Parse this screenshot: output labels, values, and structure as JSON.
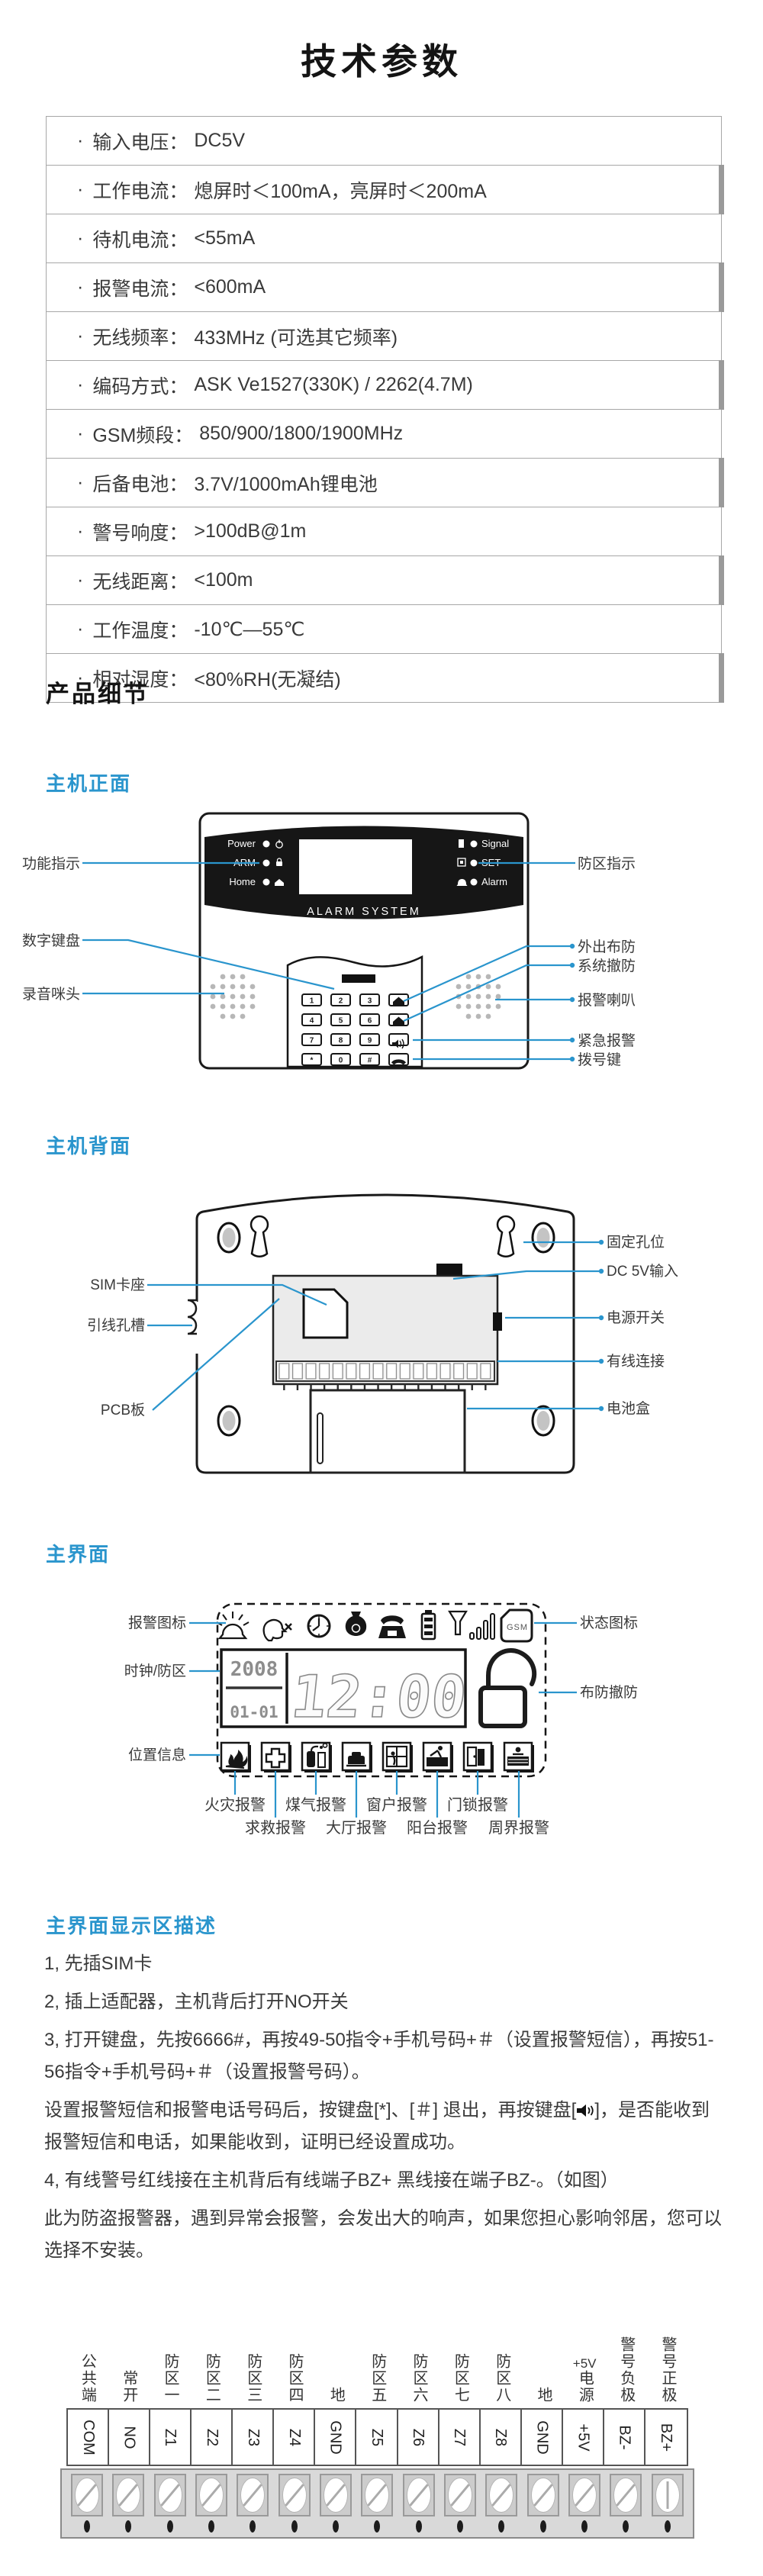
{
  "colors": {
    "accent": "#2a95cd",
    "text": "#3a3a3a",
    "table_border": "#a7a7a7",
    "row_tick": "#9a9a9a"
  },
  "title": "技术参数",
  "specs": {
    "bullet": "·",
    "rows": [
      {
        "label": "输入电压：",
        "value": "DC5V"
      },
      {
        "label": "工作电流：",
        "value": "熄屏时＜100mA，亮屏时＜200mA"
      },
      {
        "label": "待机电流：",
        "value": "<55mA"
      },
      {
        "label": "报警电流：",
        "value": "<600mA"
      },
      {
        "label": "无线频率：",
        "value": "433MHz (可选其它频率)"
      },
      {
        "label": "编码方式：",
        "value": "ASK Ve1527(330K) / 2262(4.7M)"
      },
      {
        "label": "GSM频段：",
        "value": "850/900/1800/1900MHz"
      },
      {
        "label": "后备电池：",
        "value": "3.7V/1000mAh锂电池"
      },
      {
        "label": "警号响度：",
        "value": ">100dB@1m"
      },
      {
        "label": "无线距离：",
        "value": "<100m"
      },
      {
        "label": "工作温度：",
        "value": "-10℃—55℃"
      },
      {
        "label": "相对湿度：",
        "value": "<80%RH(无凝结)"
      }
    ]
  },
  "sections": {
    "details": "产品细节",
    "front": "主机正面",
    "back": "主机背面",
    "ui": "主界面",
    "desc": "主界面显示区描述"
  },
  "front": {
    "leds_left": [
      "Power",
      "ARM",
      "Home"
    ],
    "leds_right": [
      "Signal",
      "SET",
      "Alarm"
    ],
    "brand": "ALARM SYSTEM",
    "keys": [
      "1",
      "2",
      "3",
      "4",
      "5",
      "6",
      "7",
      "8",
      "9",
      "*",
      "0",
      "#"
    ],
    "labels_left": [
      "功能指示",
      "数字键盘",
      "录音咪头"
    ],
    "labels_right": [
      "防区指示",
      "外出布防",
      "系统撤防",
      "报警喇叭",
      "紧急报警",
      "拨号键"
    ]
  },
  "back": {
    "labels_left": [
      "SIM卡座",
      "引线孔槽",
      "PCB板"
    ],
    "labels_right": [
      "固定孔位",
      "DC 5V输入",
      "电源开关",
      "有线连接",
      "电池盒"
    ]
  },
  "ui": {
    "labels_left": [
      "报警图标",
      "时钟/防区",
      "位置信息"
    ],
    "labels_right": [
      "状态图标",
      "布防撤防"
    ],
    "lcd": {
      "year": "2008",
      "date": "01-01",
      "time": "12:00",
      "gsm": "GSM"
    },
    "zone_row1": [
      "火灾报警",
      "煤气报警",
      "窗户报警",
      "门锁报警"
    ],
    "zone_row2": [
      "求救报警",
      "大厅报警",
      "阳台报警",
      "周界报警"
    ]
  },
  "desc": {
    "p1": "1, 先插SIM卡",
    "p2": "2, 插上适配器，主机背后打开NO开关",
    "p3": "3, 打开键盘，先按6666#，再按49-50指令+手机号码+＃（设置报警短信），再按51-56指令+手机号码+＃（设置报警号码）。",
    "p4a": "设置报警短信和报警电话号码后，按键盘[*]、[＃] 退出，再按键盘[",
    "p4b": "]，是否能收到报警短信和电话，如果能收到，证明已经设置成功。",
    "p5": "4, 有线警号红线接在主机背后有线端子BZ+ 黑线接在端子BZ-。（如图）",
    "p6": "此为防盗报警器，遇到异常会报警，会发出大的响声，如果您担心影响邻居，您可以选择不安装。"
  },
  "terminal": {
    "cn_labels": [
      {
        "text": "公共端"
      },
      {
        "text": "常开"
      },
      {
        "text": "防区一"
      },
      {
        "text": "防区二"
      },
      {
        "text": "防区三"
      },
      {
        "text": "防区四"
      },
      {
        "text": "地"
      },
      {
        "text": "防区五"
      },
      {
        "text": "防区六"
      },
      {
        "text": "防区七"
      },
      {
        "text": "防区八"
      },
      {
        "text": "地"
      },
      {
        "pre": "+5V",
        "text": "电源"
      },
      {
        "text": "警号负极"
      },
      {
        "text": "警号正极"
      }
    ],
    "pins": [
      "COM",
      "NO",
      "Z1",
      "Z2",
      "Z3",
      "Z4",
      "GND",
      "Z5",
      "Z6",
      "Z7",
      "Z8",
      "GND",
      "+5V",
      "BZ-",
      "BZ+"
    ]
  }
}
